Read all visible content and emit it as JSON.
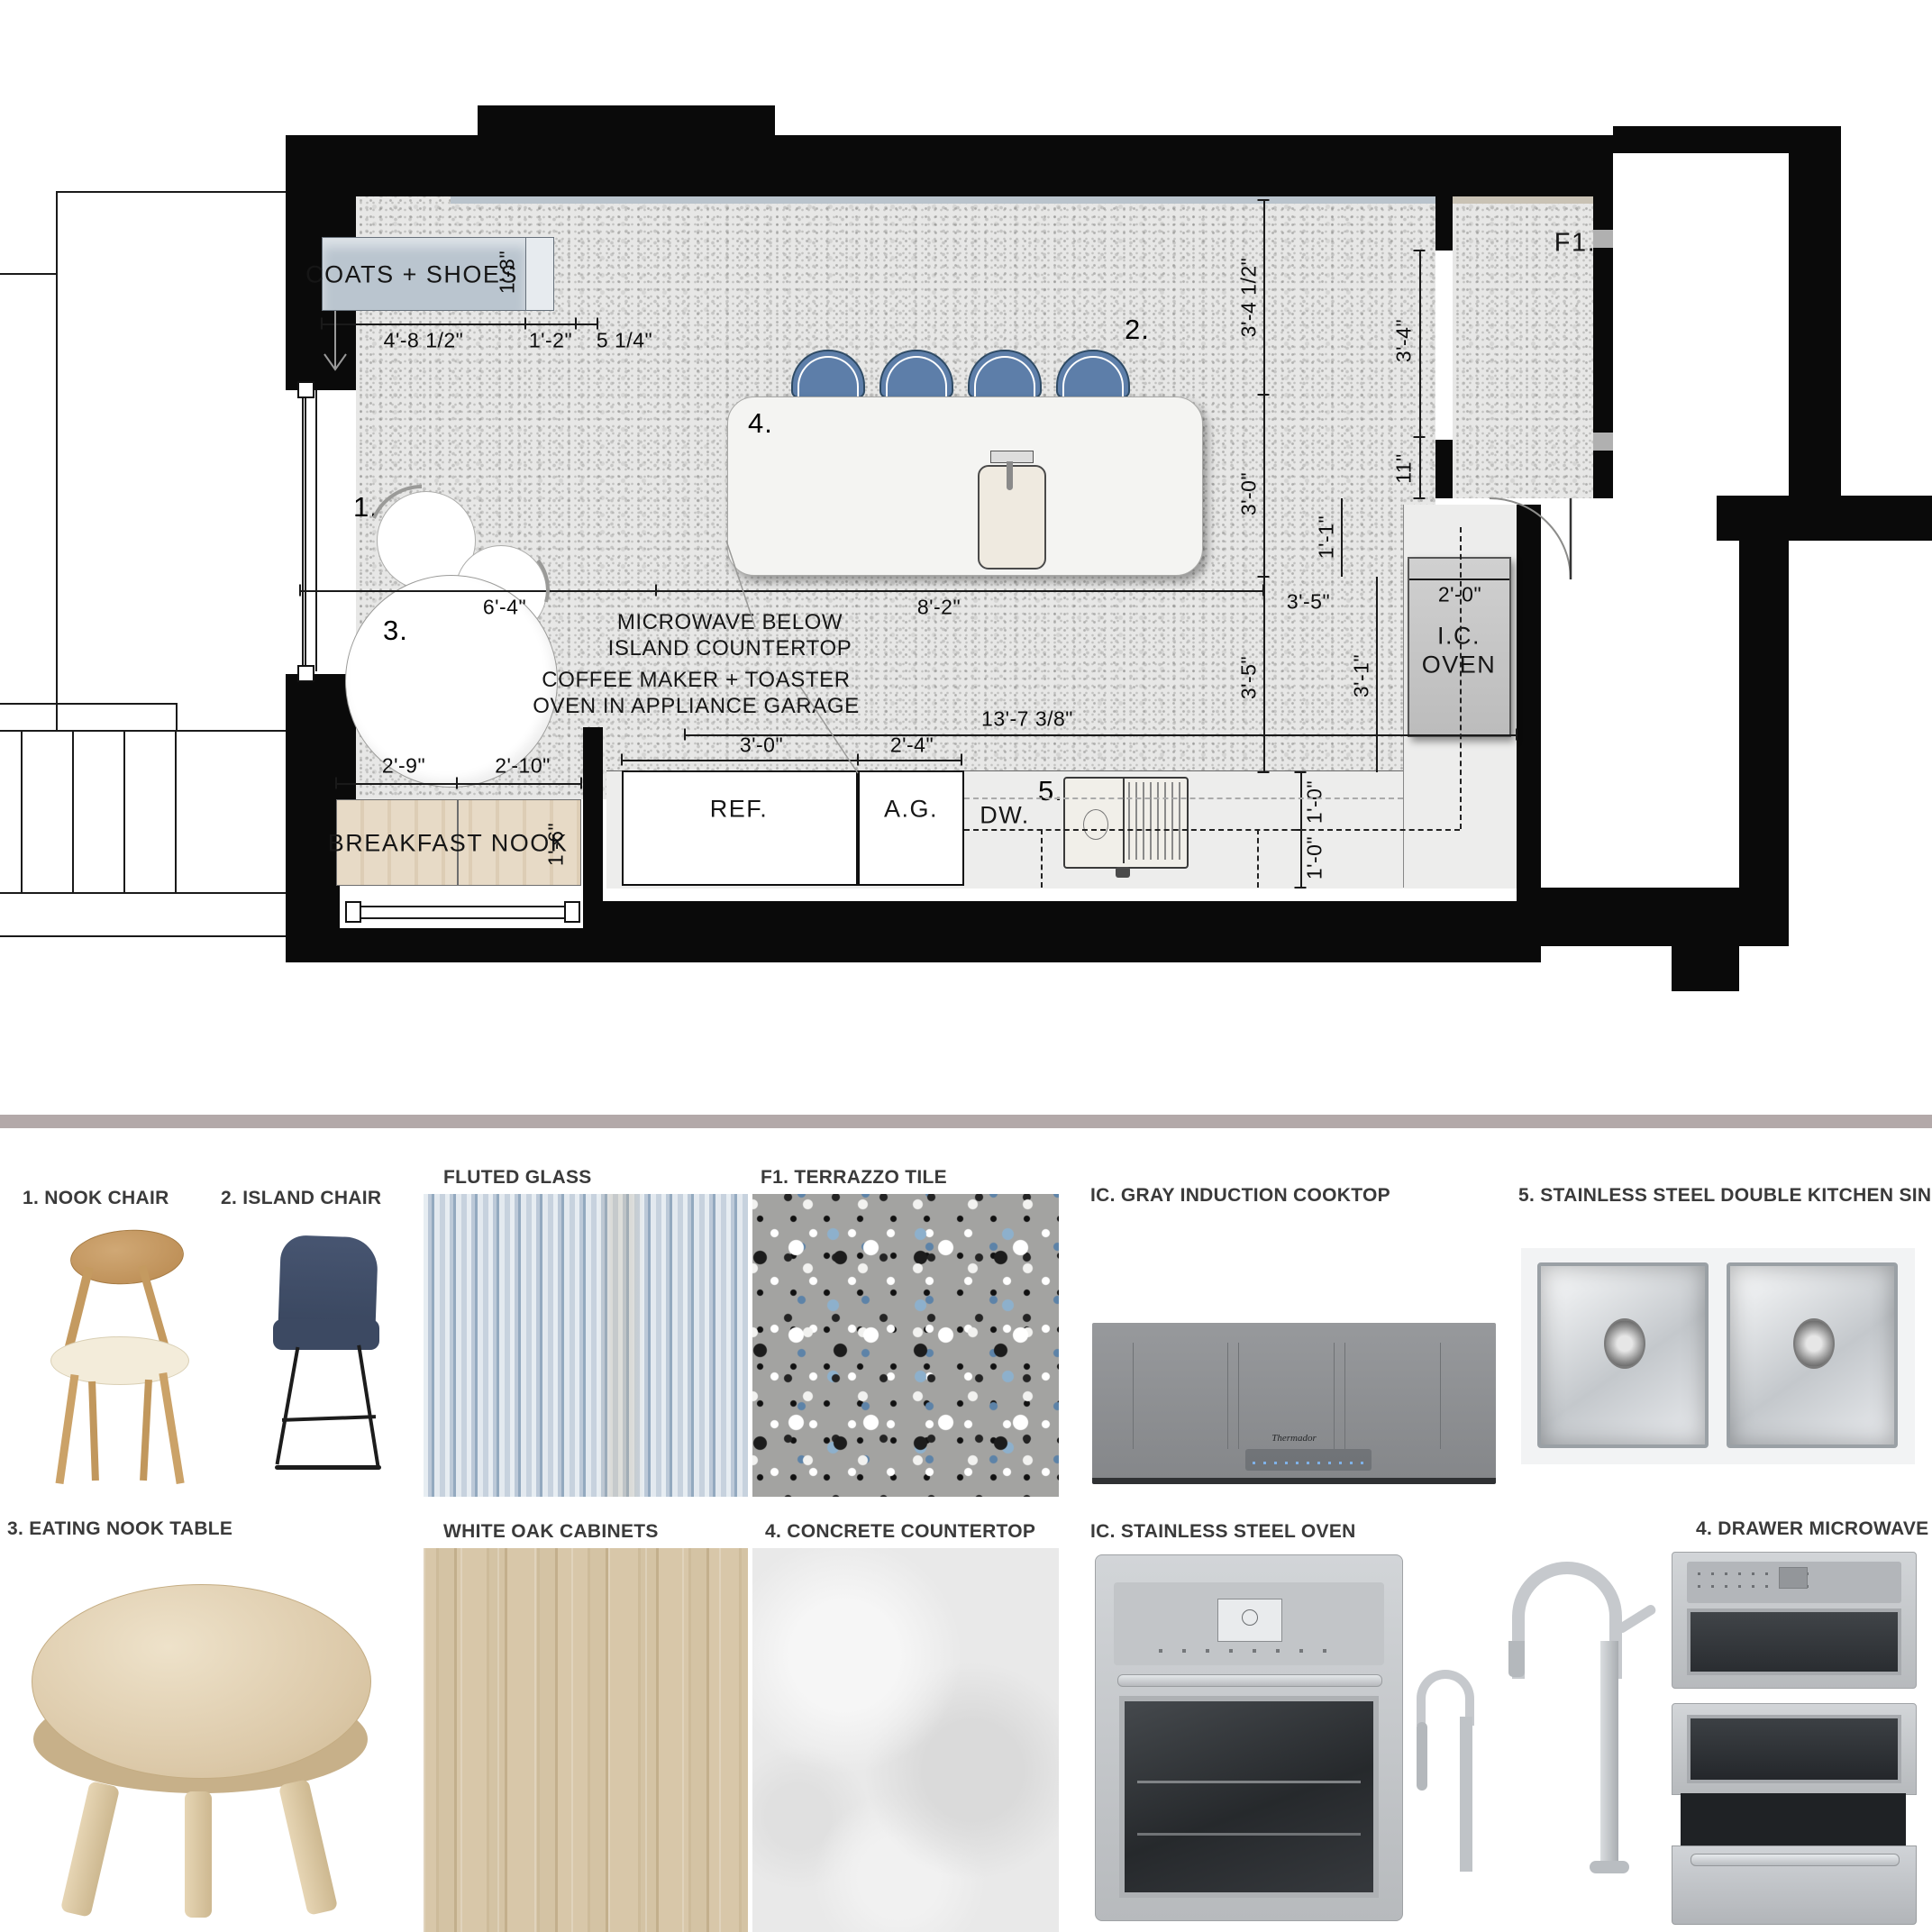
{
  "plan": {
    "room_label_f1": "F1.",
    "cabinet_coats": "COATS + SHOES",
    "bench_label": "BREAKFAST NOOK",
    "appliances": {
      "ref": "REF.",
      "ag": "A.G.",
      "dw": "DW.",
      "oven_l1": "I.C.",
      "oven_l2": "OVEN"
    },
    "callouts": {
      "nook_chair": "1.",
      "island_chair": "2.",
      "nook_table": "3.",
      "island": "4.",
      "sink": "5."
    },
    "notes": {
      "microwave_l1": "MICROWAVE BELOW",
      "microwave_l2": "ISLAND COUNTERTOP",
      "coffee_l1": "COFFEE MAKER + TOASTER",
      "coffee_l2": "OVEN IN APPLIANCE GARAGE"
    },
    "dims": {
      "coats_width": "4'-8 1/2\"",
      "coats_gap": "1'-2\"",
      "coats_small": "5 1/4\"",
      "coats_depth": "1'-3\"",
      "top_right_a": "3'-4 1/2\"",
      "top_right_b": "3'-0\"",
      "nook_width": "6'-4\"",
      "island_width": "8'-2\"",
      "right_a": "3'-5\"",
      "right_b": "3'-5\"",
      "right_c": "3'-1\"",
      "right_d": "1'-1\"",
      "right_e": "11\"",
      "pantry_opening": "3'-4\"",
      "oven_width": "2'-0\"",
      "run_total": "13'-7 3/8\"",
      "ref_width": "3'-0\"",
      "ag_width": "2'-4\"",
      "bench_a": "2'-9\"",
      "bench_b": "2'-10\"",
      "bench_depth": "1'-6\"",
      "counter_a": "1'-0\"",
      "counter_b": "1'-0\""
    }
  },
  "board": {
    "items": {
      "nook_chair": "1. NOOK CHAIR",
      "island_chair": "2. ISLAND CHAIR",
      "fluted_glass": "FLUTED GLASS",
      "terrazzo_tile": "F1. TERRAZZO TILE",
      "cooktop": "IC. GRAY INDUCTION COOKTOP",
      "sink": "5. STAINLESS STEEL DOUBLE KITCHEN SINK",
      "nook_table": "3. EATING NOOK TABLE",
      "oak_cabinets": "WHITE OAK CABINETS",
      "concrete": "4. CONCRETE COUNTERTOP",
      "oven": "IC. STAINLESS STEEL OVEN",
      "microwave": "4. DRAWER MICROWAVE",
      "cooktop_brand": "Thermador"
    }
  },
  "colors": {
    "wall_black": "#0a0a0a",
    "island_chair_blue": "#5d7ea9",
    "divider_band": "#b3a9a9",
    "coats_cabinet": "#bac5cf",
    "bench_wood": "#e2d3bd",
    "terrazzo_chip_blue": "#7fa3c0",
    "counter_gray": "#ededec"
  }
}
